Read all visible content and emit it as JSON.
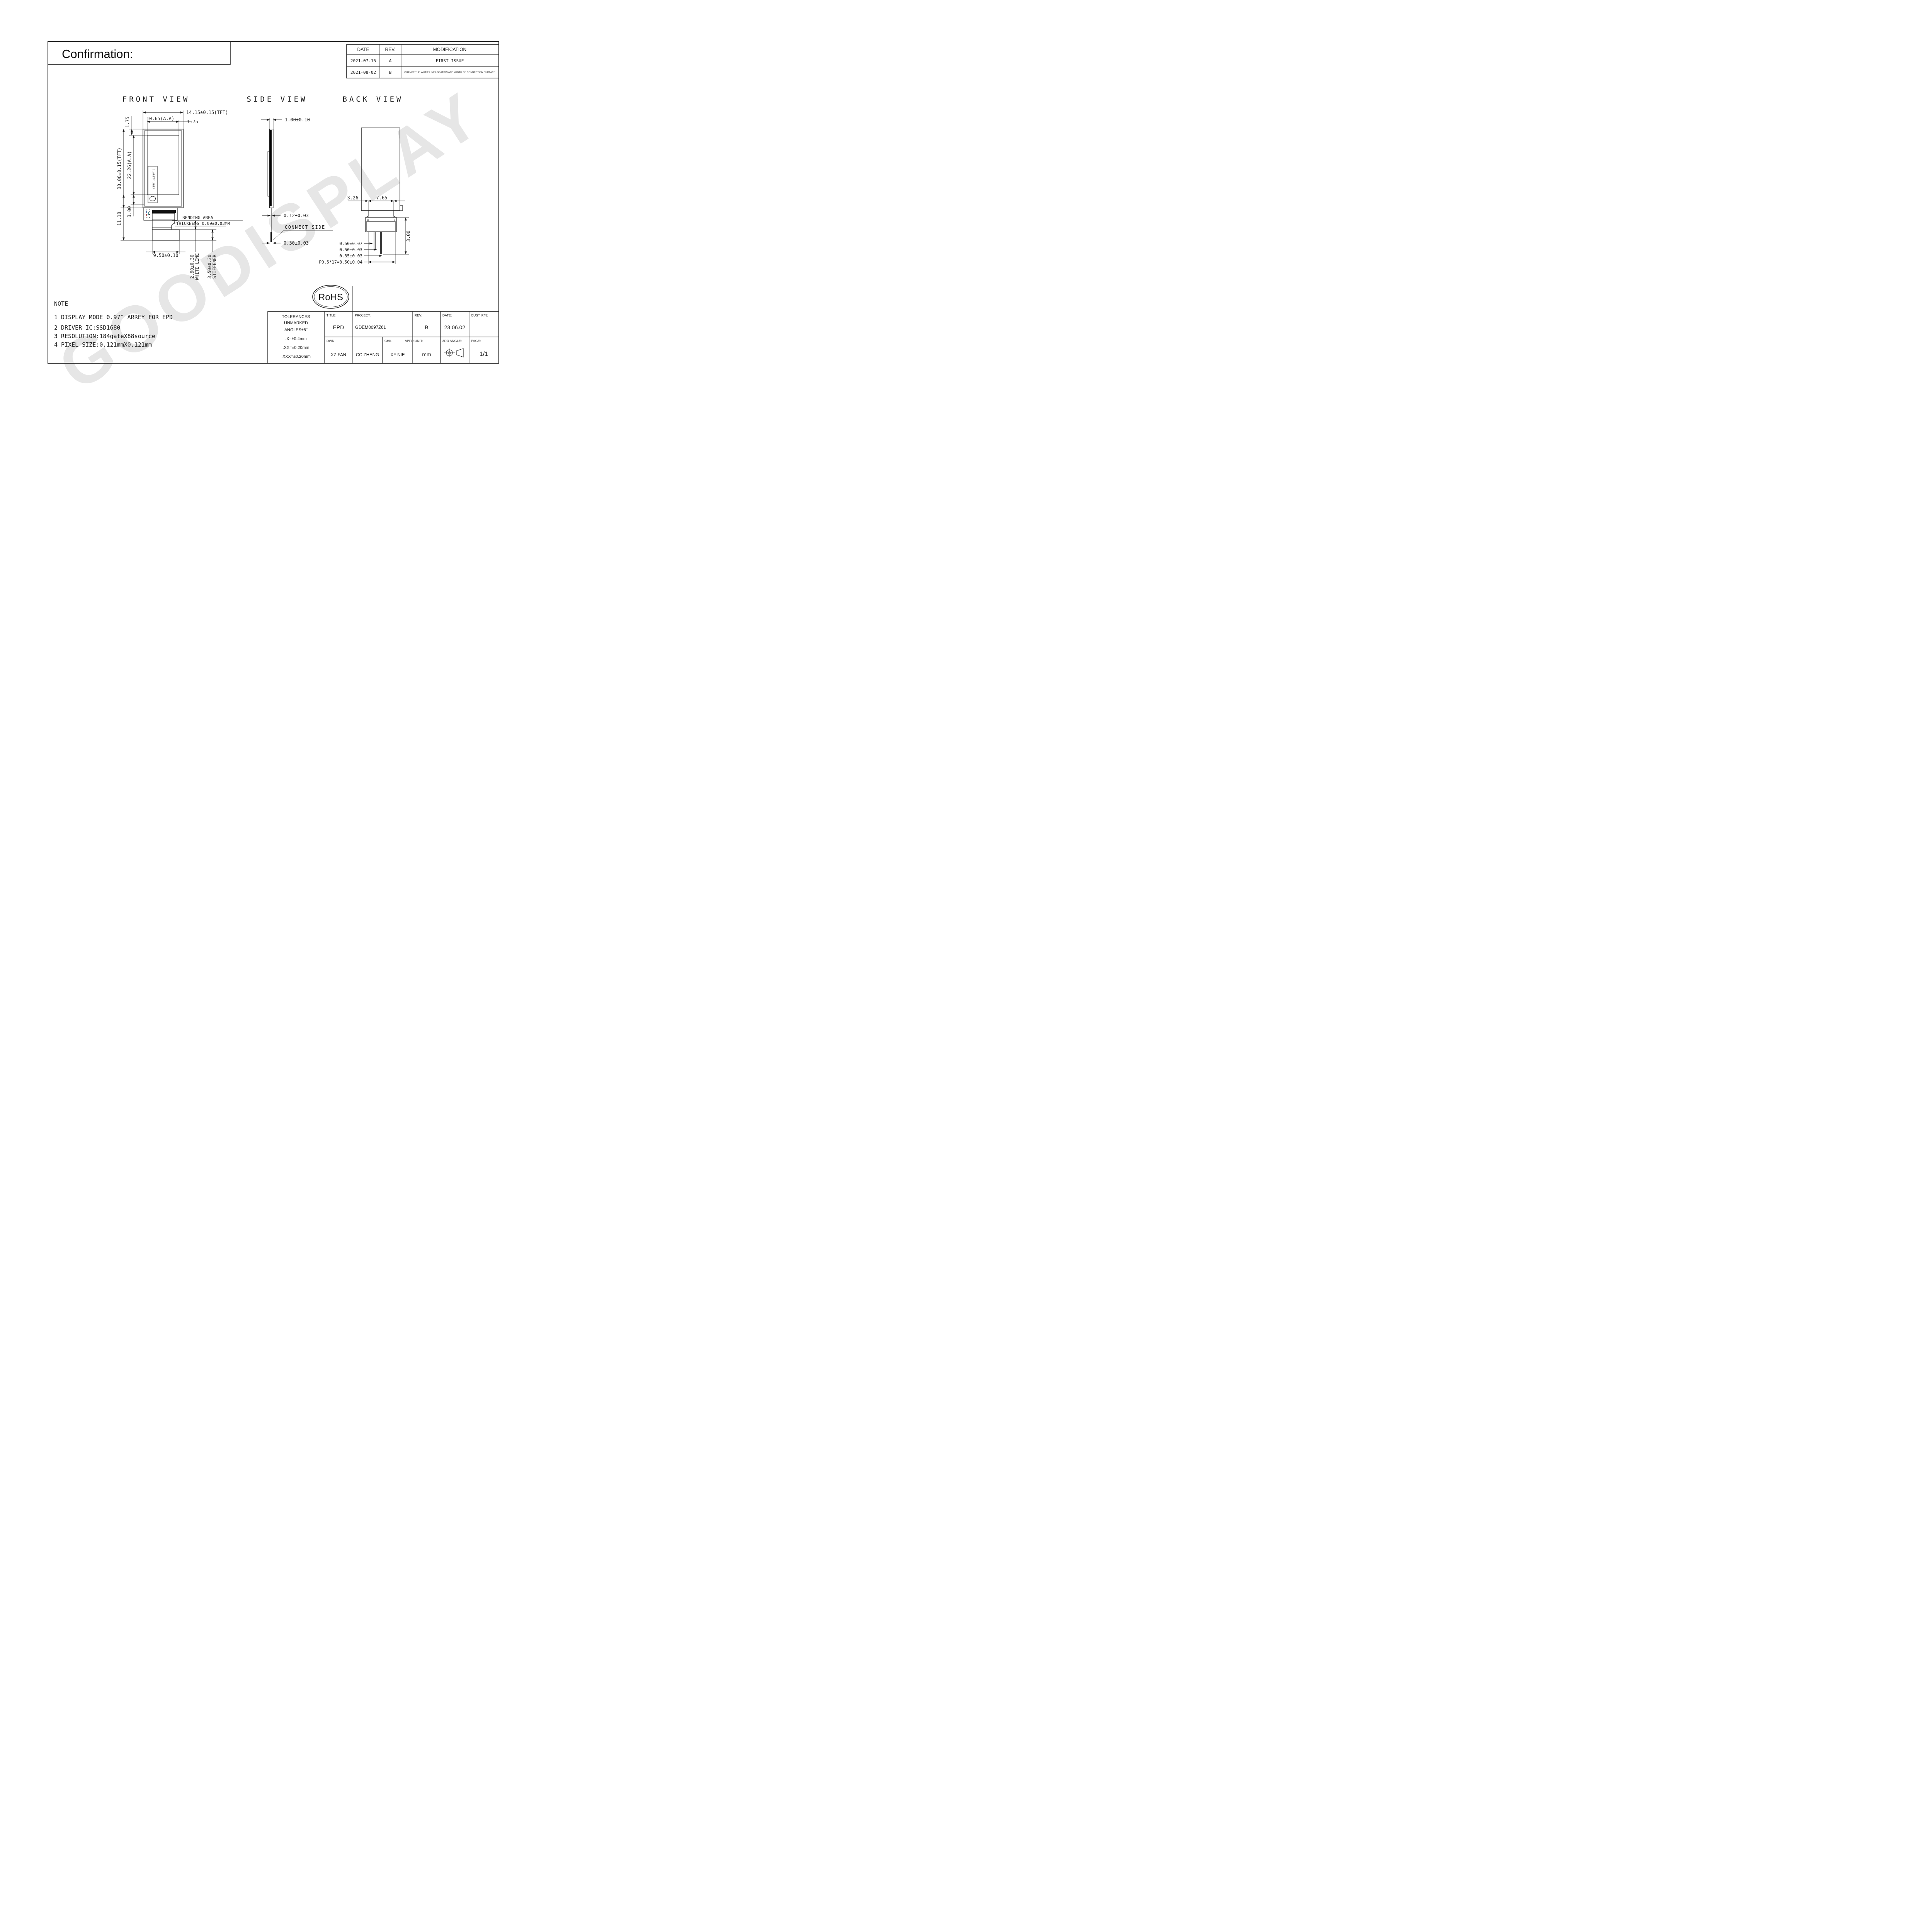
{
  "sheet": {
    "confirmation": "Confirmation:",
    "watermark": "GOODISPLAY"
  },
  "revision_table": {
    "headers": [
      "DATE",
      "REV.",
      "MODIFICATION"
    ],
    "rows": [
      {
        "date": "2021-07-15",
        "rev": "A",
        "modification": "FIRST ISSUE"
      },
      {
        "date": "2021-08-02",
        "rev": "B",
        "modification": "CHANGE THE WHTIE LINE LOCATION AND  WIDTH OF CONNECTION SURFACE"
      }
    ]
  },
  "views": {
    "front": {
      "title": "FRONT VIEW",
      "dims": {
        "width_tft": "14.15±0.15(TFT)",
        "width_aa": "10.65(A.A)",
        "margin_right": "1.75",
        "margin_top": "1.75",
        "height_tft": "30.00±0.15(TFT)",
        "height_aa": "22.26(A.A)",
        "tail_height": "11.18",
        "bend_height": "3.00",
        "stiffener_width": "9.50±0.10",
        "white_line_dim": "2.90±0.30",
        "white_line_label": "WHITE LINE",
        "stiffener_dim": "3.50±0.30",
        "stiffener_label": "STIFFENER",
        "bending_area": "BENDING AREA",
        "thickness": "THICKNESS 0.09±0.03MM",
        "clarity": "CLARITY AREA"
      }
    },
    "side": {
      "title": "SIDE VIEW",
      "dims": {
        "thickness": "1.00±0.10",
        "fpc": "0.12±0.03",
        "connect": "CONNECT SIDE",
        "bottom": "0.30±0.03"
      }
    },
    "back": {
      "title": "BACK VIEW",
      "dims": {
        "offset": "3.26",
        "width": "7.65",
        "d1": "0.50±0.07",
        "d2": "0.50±0.03",
        "d3": "0.35±0.03",
        "pitch": "P0.5*17=8.50±0.04",
        "height": "3.00",
        "pin_first": "18",
        "pin_last": "1"
      }
    }
  },
  "note": {
    "title": "NOTE",
    "items": [
      "1 DISPLAY MODE 0.97″ ARREY FOR EPD",
      "2 DRIVER IC:SSD1680",
      "3 RESOLUTION:184gateX88source",
      "4 PIXEL SIZE:0.121mmX0.121mm"
    ]
  },
  "rohs": {
    "label": "RoHS"
  },
  "title_block": {
    "tolerances": [
      "TOLERANCES",
      "UNMARKED",
      "ANGLES±5°",
      ".X=±0.4mm",
      ".XX=±0.20mm",
      ".XXX=±0.20mm"
    ],
    "title_label": "TITLE:",
    "title_value": "EPD",
    "project_label": "PROJECT:",
    "project_value": "GDEM0097Z61",
    "rev_label": "REV:",
    "rev_value": "B",
    "date_label": "DATE:",
    "date_value": "23.06.02",
    "cust_label": "CUST. P/N:",
    "dwn_label": "DWN.",
    "dwn_value": "XZ FAN",
    "chk_label": "CHK.",
    "chk_value": "CC ZHENG",
    "appr_label": "APPR.",
    "appr_value": "XF NIE",
    "unit_label": "UNIT:",
    "unit_value": "mm",
    "angle_label": "3RD ANGLE:",
    "page_label": "PAGE:",
    "page_value": "1/1"
  }
}
